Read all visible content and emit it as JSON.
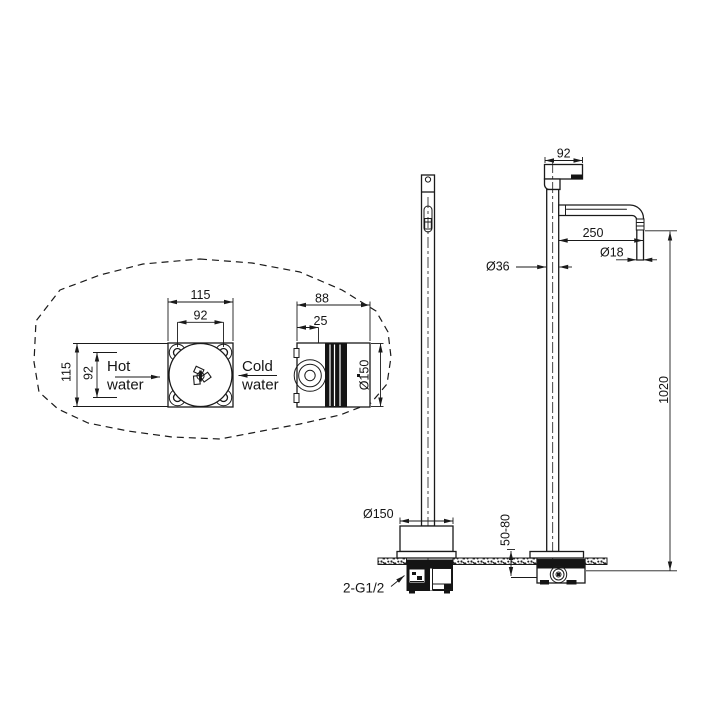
{
  "drawing": {
    "title_hint": "freestanding-faucet-installation-drawing",
    "background": "#ffffff",
    "line_color": "#1a1a1a",
    "labels": {
      "hot_line1": "Hot",
      "hot_line2": "water",
      "cold_line1": "Cold",
      "cold_line2": "water",
      "connection": "2-G1/2"
    },
    "dimensions": {
      "front_box_width": "115",
      "front_box_hole_spacing_h": "92",
      "front_box_height": "115",
      "front_box_hole_spacing_v": "92",
      "side_box_depth": "88",
      "side_box_offset": "25",
      "side_box_diameter": "Ø150",
      "handle_length": "92",
      "spout_reach": "250",
      "spout_diameter": "Ø18",
      "column_diameter": "Ø36",
      "column_height": "1020",
      "base_diameter": "Ø150",
      "floor_embed_depth": "50-80"
    }
  }
}
